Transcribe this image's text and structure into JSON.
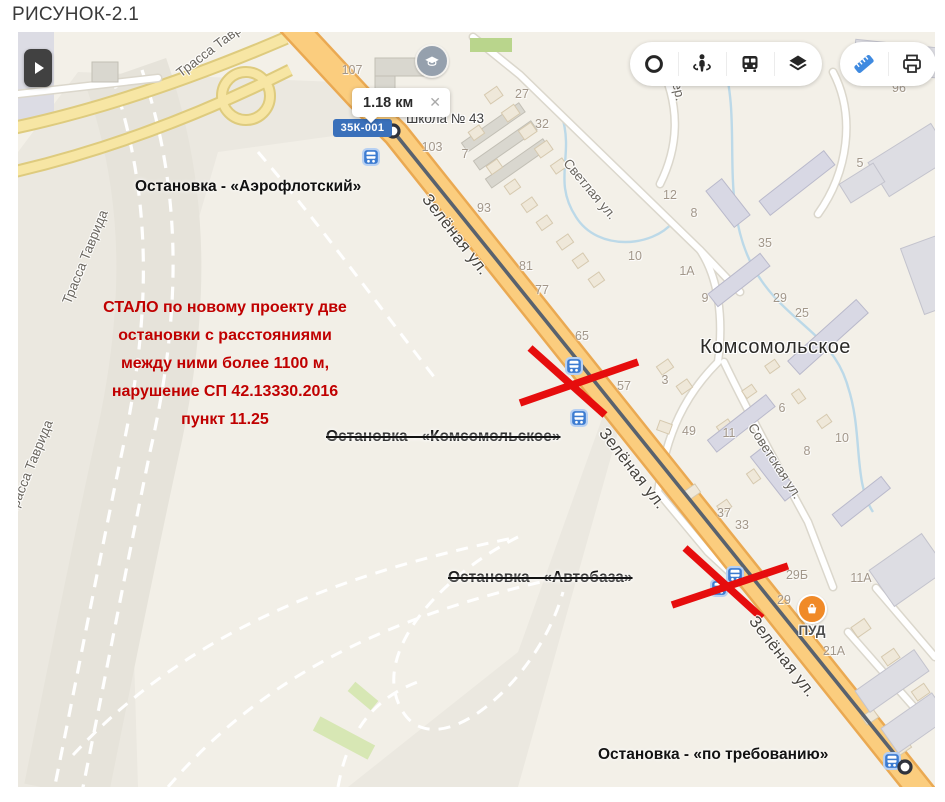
{
  "title": "РИСУНОК-2.1",
  "toolbar": {
    "icons": [
      "ring-icon",
      "panorama-person-icon",
      "bus-icon",
      "layers-icon"
    ],
    "tools": [
      "ruler-icon",
      "printer-icon"
    ],
    "ruler_active_color": "#3f8ae0"
  },
  "measure": {
    "distance": "1.18 км",
    "close": "✕"
  },
  "road_badge": "35К-001",
  "poi": {
    "school": "Школа № 43",
    "district": "Комсомольское",
    "store": "ПУД"
  },
  "stops": {
    "aeroflot": "Остановка - «Аэрофлотский»",
    "komsomolskoe": "Остановка - «Комсомольское»",
    "avtobaza": "Остановка - «Автобаза»",
    "demand": "Остановка - «по требованию»"
  },
  "note": "СТАЛО по новому проекту две\nостановки с расстояниями\nмежду ними более 1100 м,\nнарушение СП 42.13330.2016\nпункт 11.25",
  "streets": [
    {
      "t": "Зелёная ул.",
      "x": 437,
      "y": 203,
      "r": 52,
      "c": "lbl-road"
    },
    {
      "t": "Зелёная ул.",
      "x": 614,
      "y": 437,
      "r": 52,
      "c": "lbl-road"
    },
    {
      "t": "Зелёная ул.",
      "x": 764,
      "y": 625,
      "r": 52,
      "c": "lbl-road"
    },
    {
      "t": "Трасса Таврида",
      "x": 67,
      "y": 225,
      "r": -68,
      "c": "lbl-street"
    },
    {
      "t": "Трасса Таврида",
      "x": 12,
      "y": 435,
      "r": -68,
      "c": "lbl-street"
    },
    {
      "t": "Трасса Таврида",
      "x": 200,
      "y": 12,
      "r": -37,
      "c": "lbl-street"
    },
    {
      "t": "Светлая ул.",
      "x": 572,
      "y": 157,
      "r": 50,
      "c": "lbl-street"
    },
    {
      "t": "Советская ул.",
      "x": 757,
      "y": 429,
      "r": 57,
      "c": "lbl-street"
    },
    {
      "t": "пер.",
      "x": 660,
      "y": 56,
      "r": 78,
      "c": "lbl-street"
    }
  ],
  "houses": [
    {
      "t": "107",
      "x": 334,
      "y": 38
    },
    {
      "t": "27",
      "x": 504,
      "y": 62
    },
    {
      "t": "32",
      "x": 524,
      "y": 92
    },
    {
      "t": "7",
      "x": 447,
      "y": 122
    },
    {
      "t": "103",
      "x": 414,
      "y": 115
    },
    {
      "t": "93",
      "x": 466,
      "y": 176
    },
    {
      "t": "81",
      "x": 508,
      "y": 234
    },
    {
      "t": "77",
      "x": 524,
      "y": 258
    },
    {
      "t": "65",
      "x": 564,
      "y": 304
    },
    {
      "t": "57",
      "x": 606,
      "y": 354
    },
    {
      "t": "3",
      "x": 647,
      "y": 348
    },
    {
      "t": "12",
      "x": 652,
      "y": 163
    },
    {
      "t": "8",
      "x": 676,
      "y": 181
    },
    {
      "t": "10",
      "x": 617,
      "y": 224
    },
    {
      "t": "1А",
      "x": 669,
      "y": 239
    },
    {
      "t": "9",
      "x": 687,
      "y": 266
    },
    {
      "t": "35",
      "x": 747,
      "y": 211
    },
    {
      "t": "29",
      "x": 762,
      "y": 266
    },
    {
      "t": "25",
      "x": 784,
      "y": 281
    },
    {
      "t": "49",
      "x": 671,
      "y": 399
    },
    {
      "t": "11",
      "x": 711,
      "y": 401
    },
    {
      "t": "6",
      "x": 764,
      "y": 376
    },
    {
      "t": "8",
      "x": 789,
      "y": 419
    },
    {
      "t": "10",
      "x": 824,
      "y": 406
    },
    {
      "t": "37",
      "x": 706,
      "y": 481
    },
    {
      "t": "33",
      "x": 724,
      "y": 493
    },
    {
      "t": "29Б",
      "x": 779,
      "y": 543
    },
    {
      "t": "11А",
      "x": 843,
      "y": 546
    },
    {
      "t": "29",
      "x": 766,
      "y": 568
    },
    {
      "t": "21А",
      "x": 816,
      "y": 619
    },
    {
      "t": "96",
      "x": 881,
      "y": 56
    },
    {
      "t": "5",
      "x": 842,
      "y": 131
    }
  ],
  "colors": {
    "road_orange": "#fbcd7e",
    "road_casing": "#eaa952",
    "ramp_yellow": "#f7e6a4",
    "measure_line": "#59626e",
    "alert_red": "#e60d0d",
    "note_red": "#c00000",
    "badge_blue": "#3a70ba",
    "bus_blue": "#3d7cd1",
    "ruler_blue": "#3f8ae0"
  }
}
